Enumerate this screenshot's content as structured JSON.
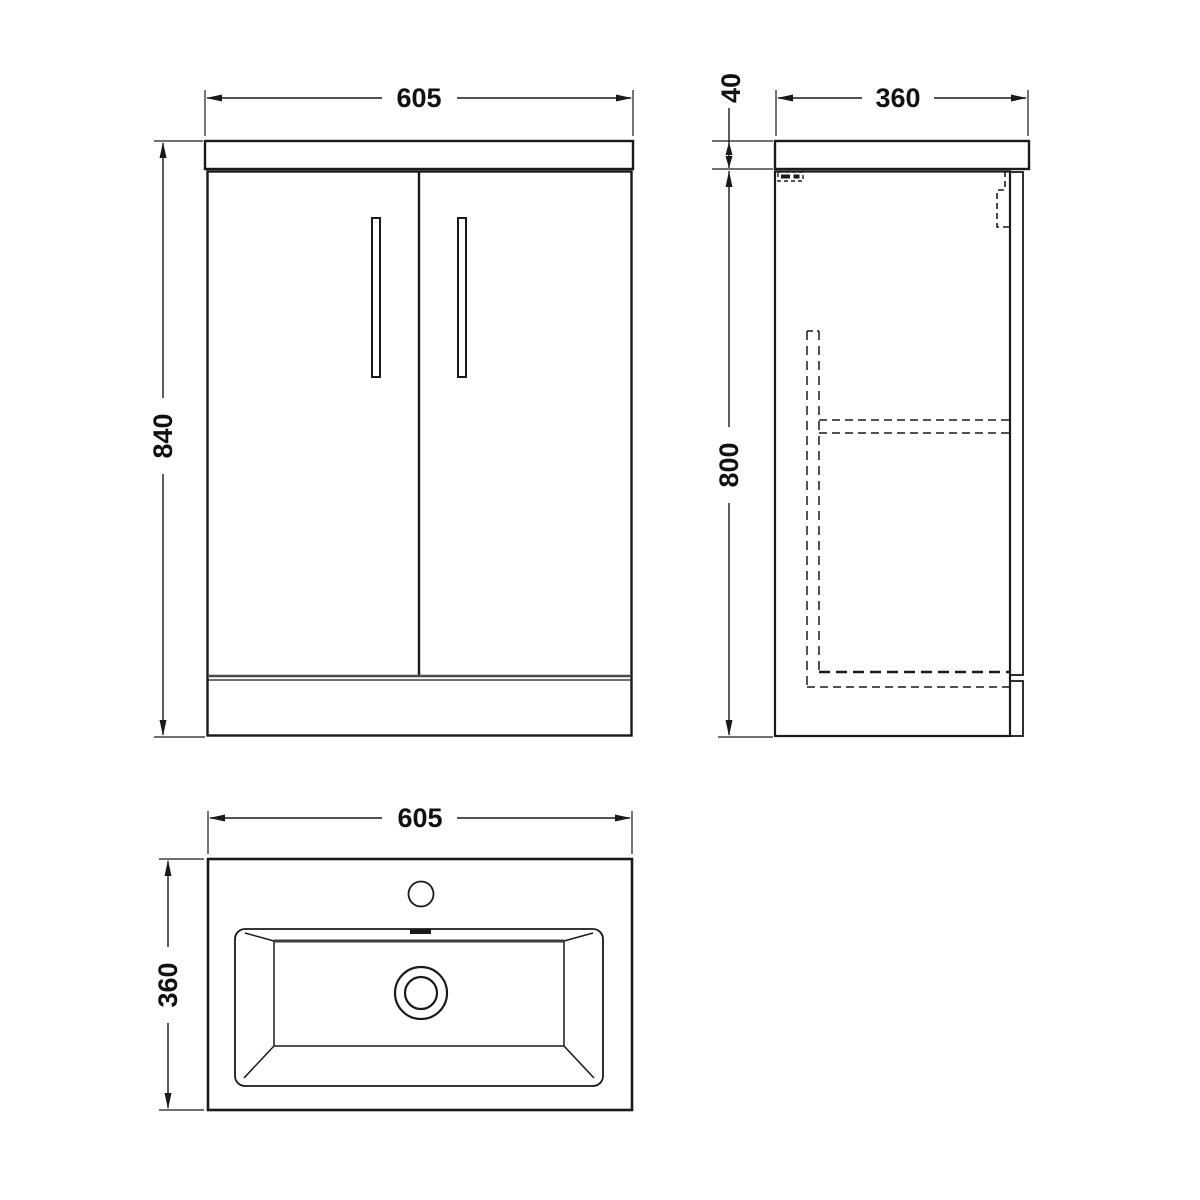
{
  "drawing": {
    "type": "technical-orthographic-drawing",
    "subject": "floor-standing vanity unit with basin",
    "background_color": "#ffffff",
    "line_color": "#1a1a1a",
    "views": [
      {
        "id": "front",
        "name": "front elevation"
      },
      {
        "id": "side",
        "name": "side elevation"
      },
      {
        "id": "plan",
        "name": "basin plan view"
      }
    ]
  },
  "dims": {
    "front_width": "605",
    "front_height": "840",
    "side_depth": "360",
    "worktop_thickness": "40",
    "cabinet_height": "800",
    "plan_width": "605",
    "plan_depth": "360"
  }
}
